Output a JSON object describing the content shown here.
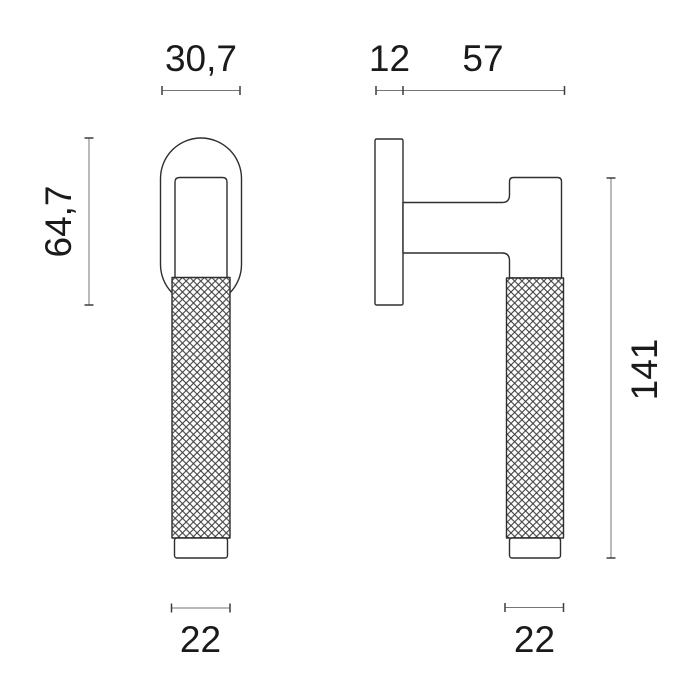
{
  "page": {
    "description": "Technical dimension drawing of a knurled lever handle, front view and side view",
    "background": "#ffffff"
  },
  "colors": {
    "outline": "#2e2e2e",
    "fill": "#ffffff",
    "dimension_line": "#757575",
    "tick": "#3f3f3f",
    "label_text": "#1a1a1a",
    "knurl_line": "#3a3a3a"
  },
  "front_view": {
    "name": "front view",
    "dim_head_width": "30,7",
    "dim_head_height": "64,7",
    "dim_grip_width": "22"
  },
  "side_view": {
    "name": "side view",
    "dim_rosette_depth": "12",
    "dim_projection": "57",
    "dim_total_height": "141",
    "dim_grip_width": "22"
  }
}
